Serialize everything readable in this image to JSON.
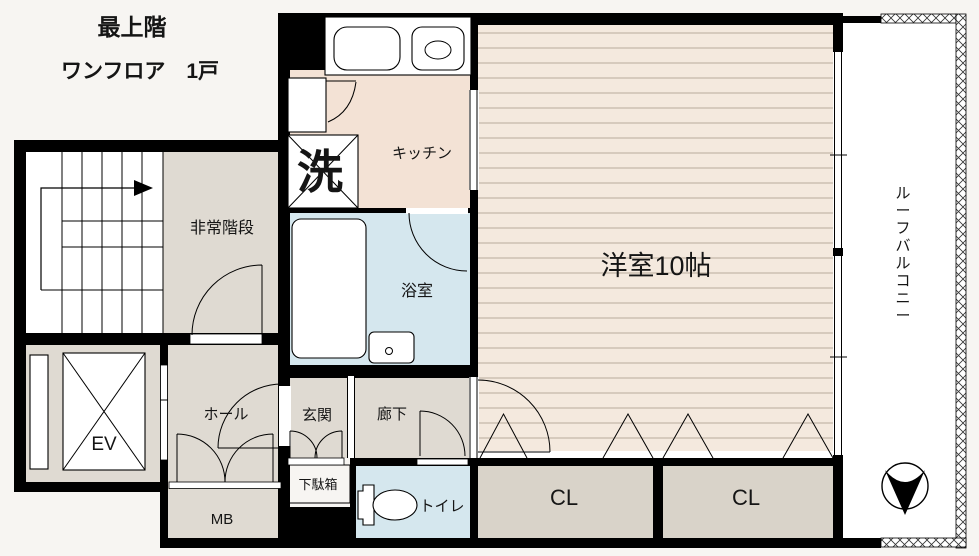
{
  "title": {
    "line1": "最上階",
    "line2": "ワンフロア　1戸"
  },
  "rooms": {
    "emergency_stairs": "非常階段",
    "kitchen": "キッチン",
    "washer": "洗",
    "bathroom": "浴室",
    "western_room": "洋室10帖",
    "roof_balcony": "ルーフバルコニー",
    "elevator": "EV",
    "hall": "ホール",
    "entrance": "玄関",
    "corridor": "廊下",
    "shoe_cabinet": "下駄箱",
    "meter_box": "MB",
    "toilet": "トイレ",
    "closet1": "CL",
    "closet2": "CL"
  },
  "colors": {
    "wall": "#000000",
    "room_beige": "#dfdad2",
    "kitchen_peach": "#f3e2d5",
    "water_blue": "#d5e7ee",
    "flooring": "#f4e9de",
    "flooring_line": "#b9ab9c",
    "closet": "#d9d3c9",
    "background": "#f7f5f2",
    "white": "#ffffff"
  }
}
